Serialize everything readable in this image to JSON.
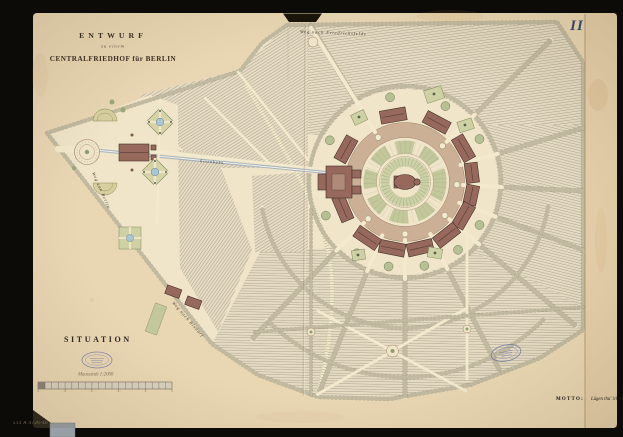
{
  "page": {
    "plate_number": "II",
    "catalog_number": "513 A 4726-46"
  },
  "title_block": {
    "line1": "ENTWURF",
    "line2": "zu einem",
    "line3": "CENTRALFRIEDHOF für BERLIN"
  },
  "legend": {
    "situation_label": "SITUATION",
    "scale_caption": "Maassstab 1:2000"
  },
  "motto": {
    "label": "MOTTO:",
    "text": "Lügen thu' ich nicht"
  },
  "map_labels": {
    "road_north": "Weg nach Friedrichsfelde",
    "road_west": "Weg von Berlin",
    "road_southwest": "Weg nach Rixdorf",
    "railway": "Eisenbahn"
  },
  "colors": {
    "background": "#0d0b07",
    "album_page": "#e9d7b4",
    "plan_paper": "#f0e5c9",
    "field_hatch": "#a69a85",
    "building": "#96695c",
    "garden": "#cdd1a4",
    "ring_road": "#c8ad92",
    "railway_blue": "#9fb0c2",
    "pond_blue": "#a9c6d4",
    "stamp_blue": "#7076a8",
    "ink": "#3a3023"
  }
}
